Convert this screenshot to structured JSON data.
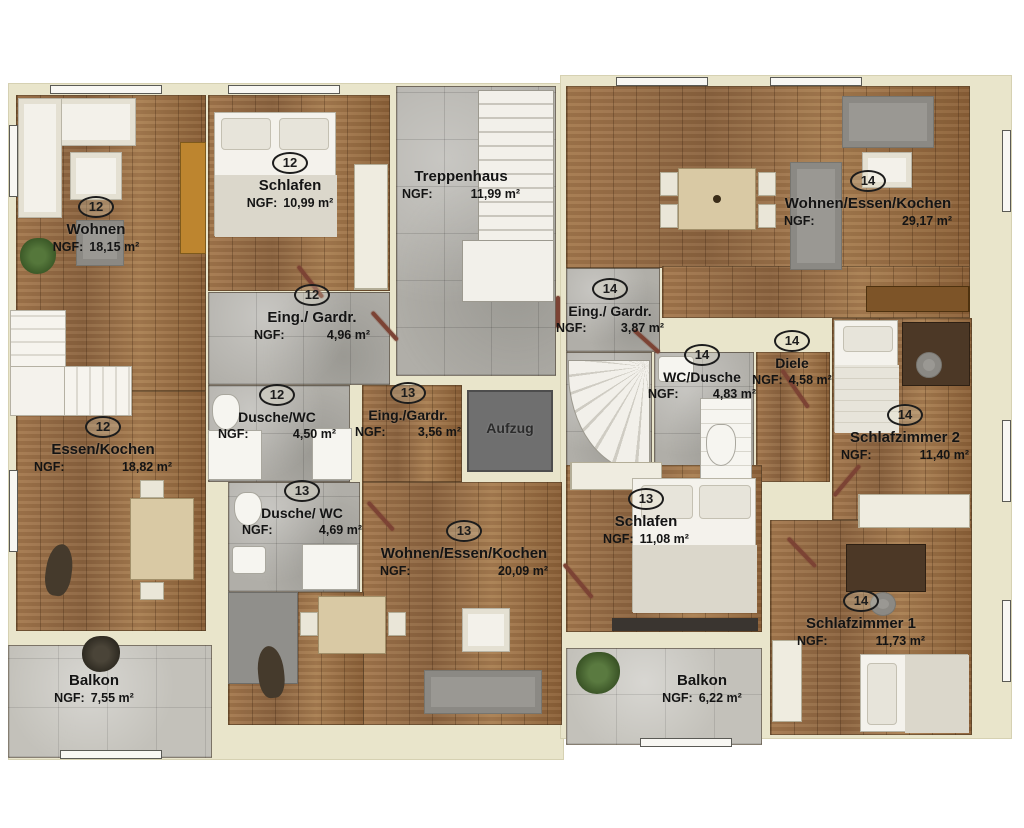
{
  "labels": {
    "ngf_prefix": "NGF:",
    "elevator": "Aufzug"
  },
  "palette": {
    "wall": "#e9e5cb",
    "wood": "#9b7149",
    "tile": "#b0aea8",
    "balcony_tile": "#c3c1ba",
    "elevator": "#6f6f6f",
    "door": "#7c4334",
    "text": "#141414",
    "fixture_white": "#f4f2ec"
  },
  "rooms": [
    {
      "key": "wohnen-12",
      "unit": "12",
      "name": "Wohnen",
      "area": "18,15 m²"
    },
    {
      "key": "schlafen-12",
      "unit": "12",
      "name": "Schlafen",
      "area": "10,99 m²"
    },
    {
      "key": "treppenhaus",
      "unit": "",
      "name": "Treppenhaus",
      "area": "11,99 m²"
    },
    {
      "key": "wek-14",
      "unit": "14",
      "name": "Wohnen/Essen/Kochen",
      "area": "29,17 m²"
    },
    {
      "key": "eing-gardr-12",
      "unit": "12",
      "name": "Eing./ Gardr.",
      "area": "4,96 m²"
    },
    {
      "key": "eing-gardr-14",
      "unit": "14",
      "name": "Eing./ Gardr.",
      "area": "3,87 m²"
    },
    {
      "key": "wc-dusche-14",
      "unit": "14",
      "name": "WC/Dusche",
      "area": "4,83 m²"
    },
    {
      "key": "diele-14",
      "unit": "14",
      "name": "Diele",
      "area": "4,58 m²"
    },
    {
      "key": "schlafzimmer-2",
      "unit": "14",
      "name": "Schlafzimmer 2",
      "area": "11,40 m²"
    },
    {
      "key": "dusche-wc-12",
      "unit": "12",
      "name": "Dusche/WC",
      "area": "4,50 m²"
    },
    {
      "key": "eing-gardr-13",
      "unit": "13",
      "name": "Eing./Gardr.",
      "area": "3,56 m²"
    },
    {
      "key": "essen-kochen-12",
      "unit": "12",
      "name": "Essen/Kochen",
      "area": "18,82 m²"
    },
    {
      "key": "dusche-wc-13",
      "unit": "13",
      "name": "Dusche/ WC",
      "area": "4,69 m²"
    },
    {
      "key": "wek-13",
      "unit": "13",
      "name": "Wohnen/Essen/Kochen",
      "area": "20,09 m²"
    },
    {
      "key": "schlafen-13",
      "unit": "13",
      "name": "Schlafen",
      "area": "11,08 m²"
    },
    {
      "key": "schlafzimmer-1",
      "unit": "14",
      "name": "Schlafzimmer 1",
      "area": "11,73 m²"
    },
    {
      "key": "balkon-left",
      "unit": "",
      "name": "Balkon",
      "area": "7,55 m²"
    },
    {
      "key": "balkon-right",
      "unit": "",
      "name": "Balkon",
      "area": "6,22 m²"
    }
  ]
}
